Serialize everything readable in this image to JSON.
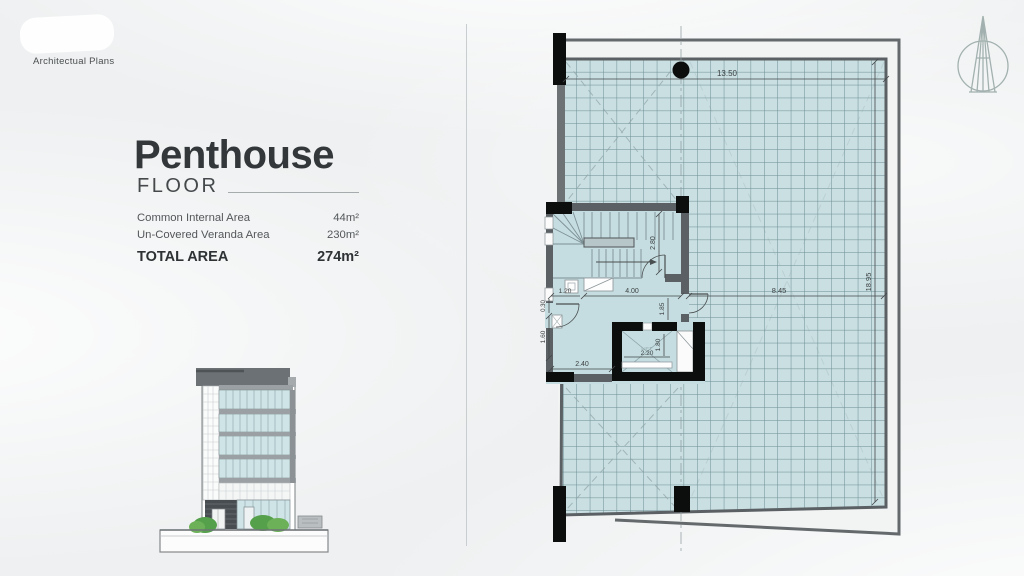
{
  "header": {
    "label": "Architectual Plans"
  },
  "title": {
    "main": "Penthouse",
    "sub": "FLOOR"
  },
  "areas": {
    "rows": [
      {
        "label": "Common Internal Area",
        "value": "44m²"
      },
      {
        "label": "Un-Covered Veranda Area",
        "value": "230m²"
      }
    ],
    "total": {
      "label": "TOTAL AREA",
      "value": "274m²"
    }
  },
  "plan": {
    "lift_label": "LIFT",
    "dims": {
      "top_width": "13.50",
      "stair_depth": "2.80",
      "hall_width": "4.00",
      "entry_width": "1.20",
      "wall_niche": "0.30",
      "left_lower": "1.60",
      "hall_bottom": "2.40",
      "lift_width": "2.20",
      "lift_depth": "1.80",
      "lobby_right": "1.85",
      "veranda_width": "8.45",
      "veranda_height": "18.95"
    }
  },
  "colors": {
    "tile_fill": "#c9dfe2",
    "tile_line": "#5f8187",
    "wall": "#5a6063",
    "column": "#0c0d0d",
    "glass": "#cfe4e7",
    "ink": "#33373a"
  }
}
